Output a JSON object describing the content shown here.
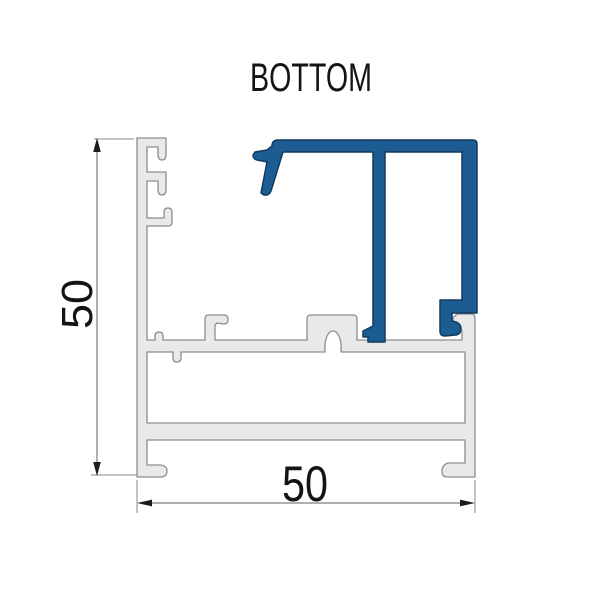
{
  "title": "BOTTOM",
  "dimensions": {
    "height": {
      "value": "50"
    },
    "width": {
      "value": "50"
    }
  },
  "colors": {
    "background": "#ffffff",
    "frame_fill": "#e9e9e9",
    "frame_stroke": "#8d8d8d",
    "insert_fill": "#1d5c92",
    "insert_stroke": "#103a61",
    "dim_line": "#5f5f5f",
    "ext_line": "#8a8a8a",
    "arrow": "#1c1c1c",
    "text": "#141414"
  }
}
